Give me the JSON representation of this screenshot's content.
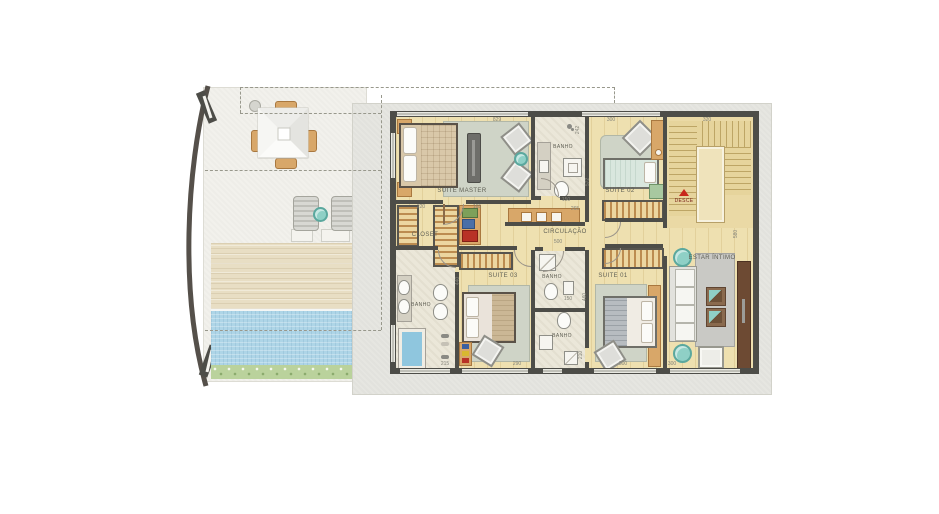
{
  "plan": {
    "rooms": {
      "suite_master": {
        "label": "SUITE MASTER"
      },
      "banho_top": {
        "label": "BANHO"
      },
      "suite_02": {
        "label": "SUITE 02"
      },
      "closet": {
        "label": "CLOSET"
      },
      "circulacao": {
        "label": "CIRCULAÇÃO"
      },
      "suite_03": {
        "label": "SUITE 03"
      },
      "banho_master": {
        "label": "BANHO"
      },
      "banho_mid_top": {
        "label": "BANHO"
      },
      "banho_mid_bottom": {
        "label": "BANHO"
      },
      "suite_01": {
        "label": "SUITE 01"
      },
      "estar_intimo": {
        "label": "ESTAR ÍNTIMO"
      }
    },
    "stairs": {
      "direction_label": "DESCE"
    },
    "dimension_labels": [
      {
        "text": "829",
        "x": 497,
        "y": 120
      },
      {
        "text": "242",
        "x": 578,
        "y": 130,
        "rot": true
      },
      {
        "text": "300",
        "x": 611,
        "y": 120
      },
      {
        "text": "320",
        "x": 707,
        "y": 120
      },
      {
        "text": "220",
        "x": 421,
        "y": 207
      },
      {
        "text": "165",
        "x": 477,
        "y": 207
      },
      {
        "text": "150",
        "x": 566,
        "y": 200
      },
      {
        "text": "265",
        "x": 575,
        "y": 209
      },
      {
        "text": "572",
        "x": 588,
        "y": 182,
        "rot": true
      },
      {
        "text": "500",
        "x": 558,
        "y": 242
      },
      {
        "text": "440",
        "x": 458,
        "y": 281,
        "rot": true
      },
      {
        "text": "460",
        "x": 585,
        "y": 297,
        "rot": true
      },
      {
        "text": "150",
        "x": 568,
        "y": 299
      },
      {
        "text": "210",
        "x": 581,
        "y": 355,
        "rot": true
      },
      {
        "text": "215",
        "x": 445,
        "y": 364
      },
      {
        "text": "290",
        "x": 517,
        "y": 364
      },
      {
        "text": "300",
        "x": 623,
        "y": 364
      },
      {
        "text": "300",
        "x": 672,
        "y": 364
      },
      {
        "text": "580",
        "x": 736,
        "y": 234,
        "rot": true
      }
    ],
    "colors": {
      "wall": "#4d4d48",
      "wood_floor": "#eee0b0",
      "bathroom_floor": "#ebe7d9",
      "rug": "#cfd4c7",
      "stairs": "#ead9a5",
      "slab": "#e6e6e1",
      "terrace": "#f2f1ec",
      "deck": "#e8dec4",
      "pool": "#aed5e7",
      "garden": "#bad29c",
      "accent_wood": "#d8a769",
      "dark_panel": "#6d4a33",
      "teal": "#8fd0c6",
      "stair_marker_red": "#c8281c"
    }
  }
}
